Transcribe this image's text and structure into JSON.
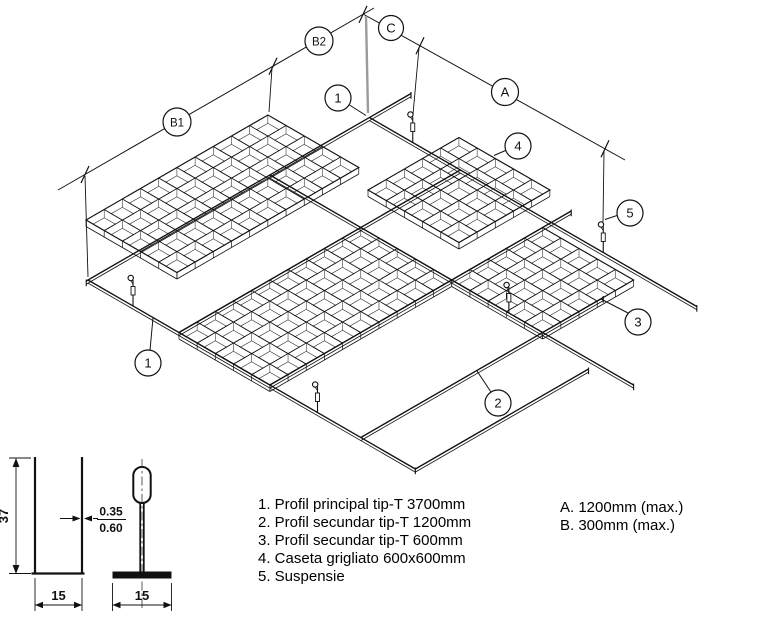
{
  "drawing": {
    "dim_labels": {
      "b1": "B1",
      "b2": "B2",
      "c": "C",
      "a": "A"
    },
    "callouts": {
      "c1": "1",
      "c2": "2",
      "c3": "3",
      "c4": "4",
      "c5": "5"
    }
  },
  "section": {
    "height": "37",
    "width_left": "15",
    "width_right": "15",
    "thickness_top": "0.35",
    "thickness_bottom": "0.60"
  },
  "legend": {
    "items": [
      "1. Profil principal tip-T 3700mm",
      "2. Profil secundar tip-T 1200mm",
      "3. Profil secundar tip-T 600mm",
      "4. Caseta grigliato 600x600mm",
      "5. Suspensie"
    ],
    "notes": [
      "A. 1200mm (max.)",
      "B. 300mm (max.)"
    ]
  },
  "colors": {
    "line": "#111111",
    "extension_gray": "#9b9b9b",
    "background": "#ffffff"
  }
}
